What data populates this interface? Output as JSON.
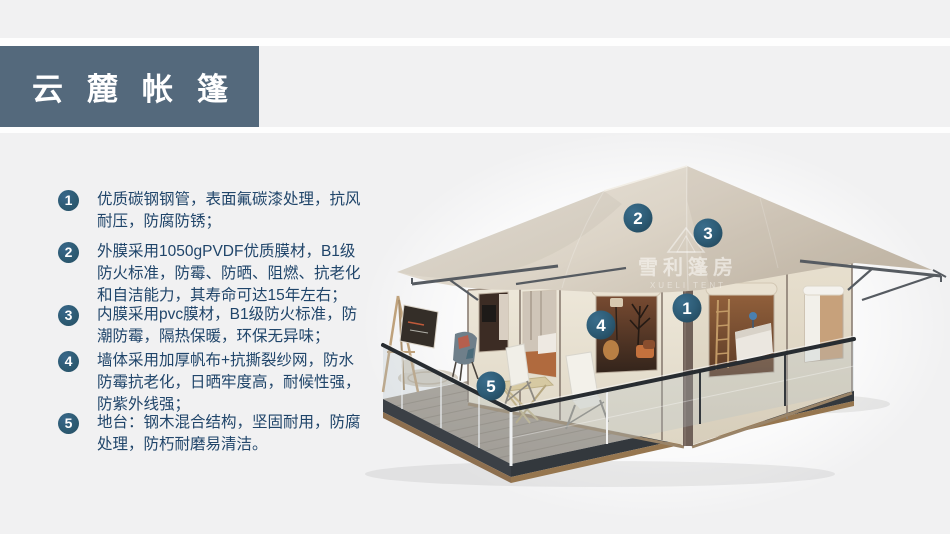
{
  "header": {
    "title": "云麓帐篷",
    "bar_color": "#54697c",
    "text_color": "#ffffff"
  },
  "features": [
    {
      "num": "1",
      "text": "优质碳钢钢管，表面氟碳漆处理，抗风耐压，防腐防锈；"
    },
    {
      "num": "2",
      "text": "外膜采用1050gPVDF优质膜材，B1级防火标准，防霉、防晒、阻燃、抗老化和自洁能力，其寿命可达15年左右；"
    },
    {
      "num": "3",
      "text": "内膜采用pvc膜材，B1级防火标准，防潮防霉，隔热保暖，环保无异味；"
    },
    {
      "num": "4",
      "text": "墙体采用加厚帆布+抗撕裂纱网，防水防霉抗老化，日晒牢度高，耐候性强，防紫外线强；"
    },
    {
      "num": "5",
      "text": "地台：钢木混合结构，坚固耐用，防腐处理，防朽耐磨易清洁。"
    }
  ],
  "tent": {
    "markers": [
      "1",
      "2",
      "3",
      "4",
      "5"
    ],
    "watermark": {
      "cn": "雪利篷房",
      "en": "XUELI TENT"
    }
  },
  "colors": {
    "page_background": "#f1f1f2",
    "accent_circle": "#2d5b73",
    "marker_circle": "#2e5d77",
    "body_text": "#20456a",
    "roof_canvas": "#ddd5c8",
    "wall_canvas": "#e9e2d2",
    "steel_frame": "#565b61",
    "deck_floor": "#a89c90",
    "deck_base": "#3b4046",
    "deck_wood": "#8d6f4f"
  }
}
